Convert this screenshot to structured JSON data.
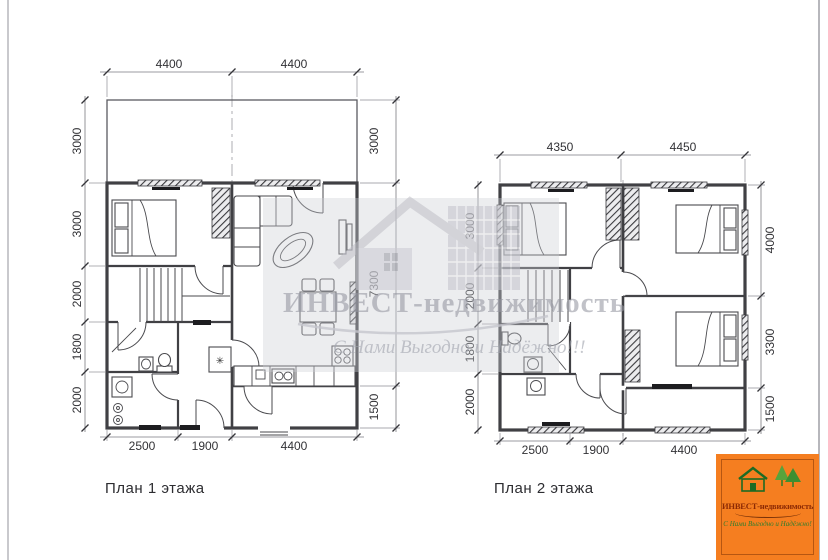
{
  "plans": [
    {
      "label": "План 1 этажа",
      "dims_top": [
        "4400",
        "4400"
      ],
      "dims_left": [
        "3000",
        "3000",
        "2000",
        "1800",
        "2000"
      ],
      "dims_right": [
        "3000",
        "7300",
        "1500"
      ],
      "dims_bottom": [
        "2500",
        "1900",
        "4400"
      ],
      "closet_symbol": "✳"
    },
    {
      "label": "План 2 этажа",
      "dims_top": [
        "4350",
        "4450"
      ],
      "dims_left": [
        "3000",
        "2000",
        "1800",
        "2000"
      ],
      "dims_right": [
        "4000",
        "3300",
        "1500"
      ],
      "dims_bottom": [
        "2500",
        "1900",
        "4400"
      ]
    }
  ],
  "watermark": {
    "brand": "ИНВЕСТ-недвижимость",
    "tagline": "С Нами Выгодно и Надёжно!!!",
    "color": "#b9bac2"
  },
  "logo": {
    "brand": "ИНВЕСТ-недвижимость",
    "tagline": "С Нами Выгодно и Надёжно!",
    "background": "#f57e20",
    "brand_color": "#8c2a04",
    "tagline_color": "#2e7d2e"
  }
}
